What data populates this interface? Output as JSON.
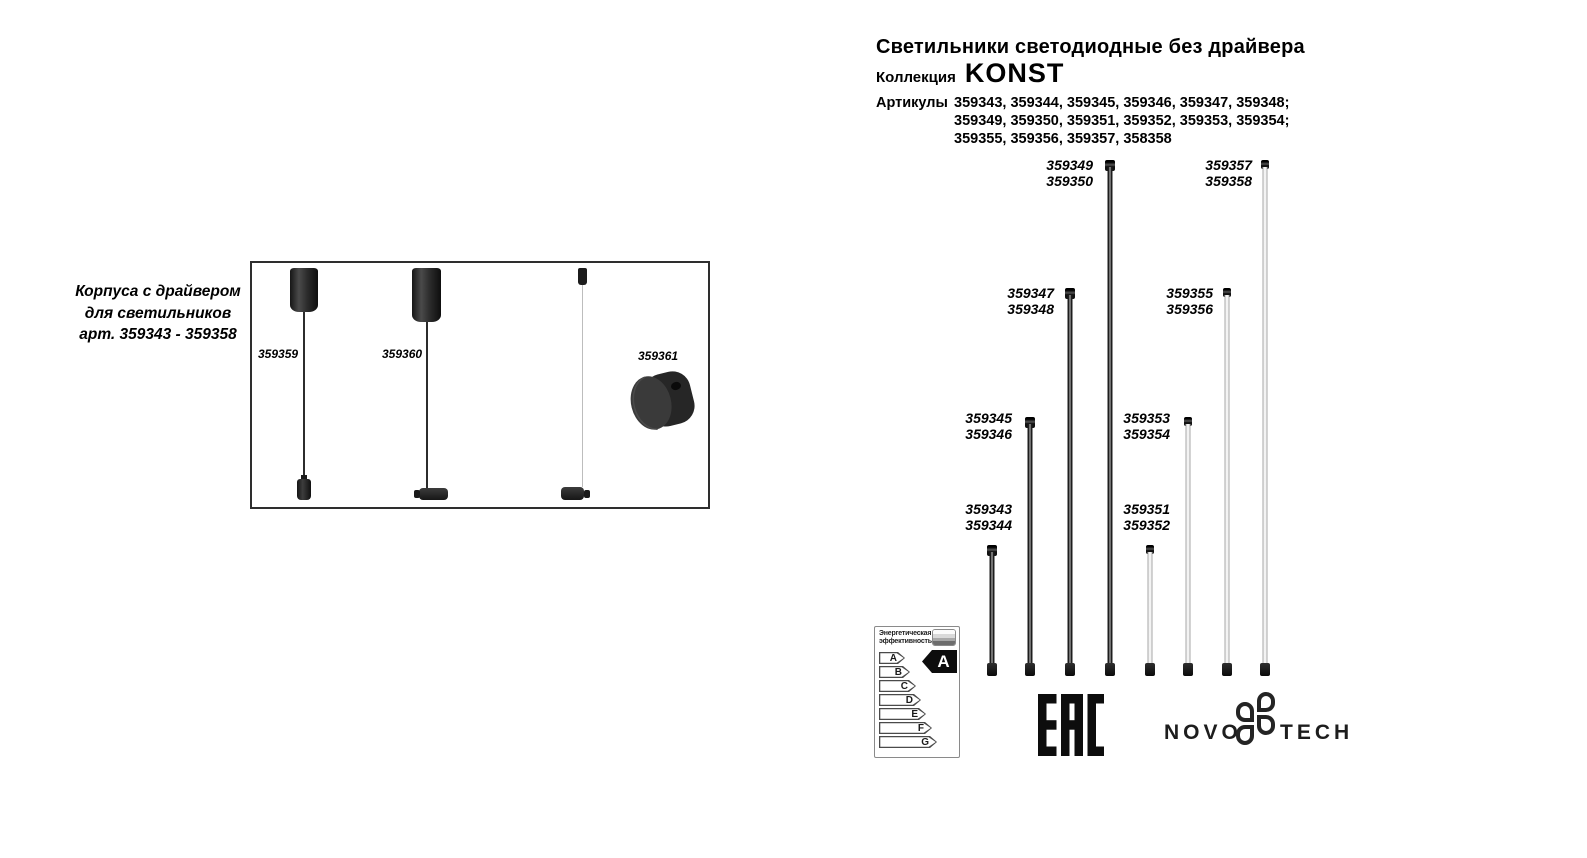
{
  "header": {
    "title": "Светильники светодиодные без драйвера",
    "collection_label": "Коллекция",
    "collection_name": "KONST",
    "articles_label": "Артикулы",
    "articles_lines": [
      "359343, 359344, 359345, 359346, 359347, 359348;",
      "359349, 359350, 359351, 359352, 359353, 359354;",
      "359355, 359356, 359357, 358358"
    ]
  },
  "left_panel": {
    "caption_lines": [
      "Корпуса с драйвером",
      "для светильников",
      "арт. 359343 - 359358"
    ],
    "items": [
      {
        "label": "359359"
      },
      {
        "label": "359360"
      },
      {
        "label": "359361"
      }
    ]
  },
  "diagram": {
    "tubes": [
      {
        "label_lines": [
          "359343",
          "359344"
        ],
        "color": "black",
        "length": "short"
      },
      {
        "label_lines": [
          "359345",
          "359346"
        ],
        "color": "black",
        "length": "medium"
      },
      {
        "label_lines": [
          "359347",
          "359348"
        ],
        "color": "black",
        "length": "long"
      },
      {
        "label_lines": [
          "359349",
          "359350"
        ],
        "color": "black",
        "length": "extra-long"
      },
      {
        "label_lines": [
          "359351",
          "359352"
        ],
        "color": "white",
        "length": "short"
      },
      {
        "label_lines": [
          "359353",
          "359354"
        ],
        "color": "white",
        "length": "medium"
      },
      {
        "label_lines": [
          "359355",
          "359356"
        ],
        "color": "white",
        "length": "long"
      },
      {
        "label_lines": [
          "359357",
          "359358"
        ],
        "color": "white",
        "length": "extra-long"
      }
    ],
    "tube_black_hex": "#1d1d1d",
    "tube_white_hex": "#ededed"
  },
  "energy_label": {
    "header_lines": [
      "Энергетическая",
      "эффективность"
    ],
    "classes": [
      "A",
      "B",
      "C",
      "D",
      "E",
      "F",
      "G"
    ],
    "rating": "A"
  },
  "footer": {
    "eac": "EAC",
    "brand_left": "NOVO",
    "brand_right": "TECH"
  }
}
